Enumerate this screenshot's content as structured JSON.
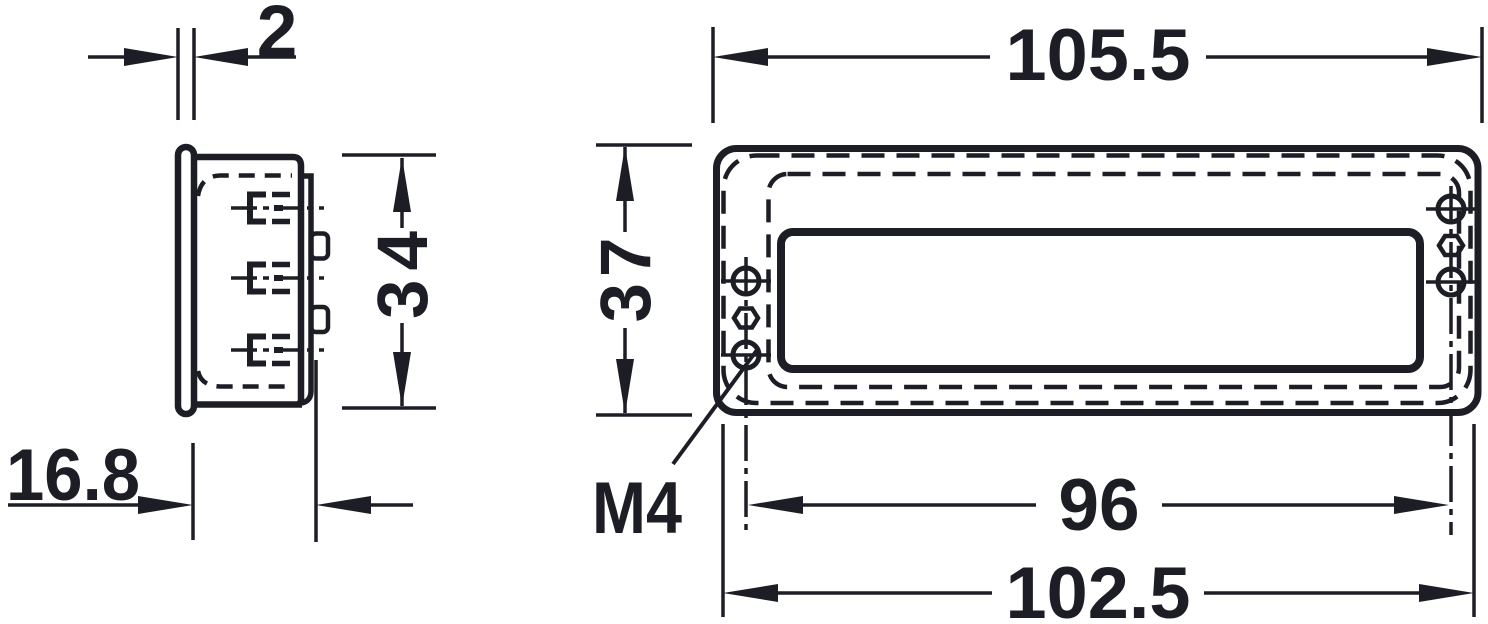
{
  "page": {
    "background_color": "#ffffff",
    "line_color": "#1d1d26"
  },
  "side_view": {
    "dims": {
      "flange_thickness": "2",
      "body_height": "34",
      "mounting_depth": "16.8"
    }
  },
  "front_view": {
    "dims": {
      "overall_width": "105.5",
      "overall_height": "37",
      "hole_spacing": "96",
      "cutout_width": "102.5"
    },
    "thread_label": "M4"
  }
}
